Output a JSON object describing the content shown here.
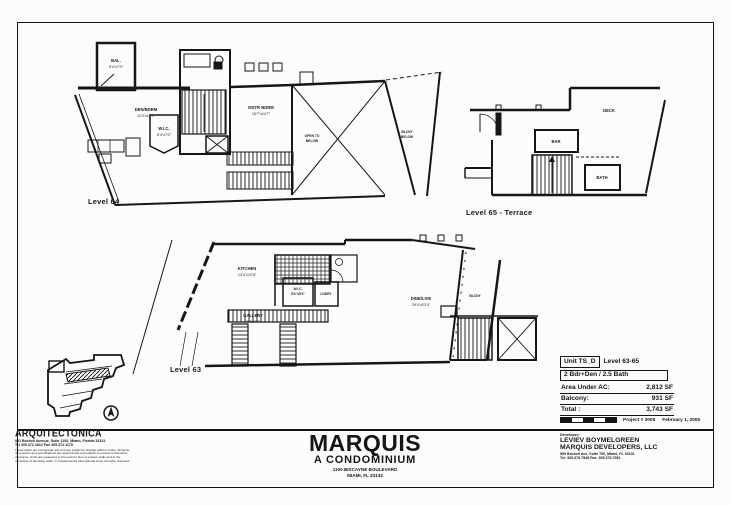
{
  "colors": {
    "ink": "#161616",
    "paper": "#fcfcfa"
  },
  "sheet": {
    "title": "MARQUIS",
    "subtitle": "A CONDOMINIUM",
    "address_line1": "1100 BISCAYNE BOULEVARD",
    "address_line2": "MIAMI, FL 33132"
  },
  "plans": {
    "level64": {
      "label": "Level 64",
      "rooms": {
        "bal": "BAL.",
        "bal_dim": "5'4\"x7'0\"",
        "den": "DEN/BDRM",
        "den_dim": "11'0\"x12'0\"",
        "wic": "W.I.C.",
        "wic_dim": "6'4\"x7'0\"",
        "mstr": "MSTR BDRM",
        "mstr_dim": "15'7\"x14'7\"",
        "open1": "OPEN TO",
        "open2": "BELOW",
        "bal_below1": "BLCNY",
        "bal_below2": "BELOW"
      }
    },
    "level65": {
      "label": "Level 65 - Terrace",
      "rooms": {
        "deck": "DECK",
        "bar": "BAR",
        "bath": "BATH"
      }
    },
    "level63": {
      "label": "Level 63",
      "rooms": {
        "kitchen": "KITCHEN",
        "kitchen_dim": "13'4\"x10'6\"",
        "wic": "W.I.C.",
        "wic_dim": "5'4\"x5'4\"",
        "lndry": "LNDRY",
        "gallery": "GALLERY",
        "gallery_dim": "7'4\"x7'4\"",
        "dine": "DINE/LIVE",
        "dine_dim": "29'4\"x23'4\"",
        "balcony": "BLCNY"
      }
    }
  },
  "unit_info": {
    "unit_label": "Unit TS_D",
    "level_label": "Level 63-65",
    "config": "2 Bdr+Den / 2.5 Bath",
    "rows": [
      {
        "label": "Area Under AC:",
        "value": "2,812 SF"
      },
      {
        "label": "Balcony:",
        "value": "931 SF"
      },
      {
        "label": "Total :",
        "value": "3,743 SF"
      }
    ]
  },
  "project_meta": {
    "project": "Project # 2005",
    "date": "February 1, 2005"
  },
  "architect": {
    "name": "ARQUITECTONICA",
    "address": "801 Brickell Avenue, Suite 1100, Miami, Florida 33131",
    "phone": "Tel 305.372.1812   Fax 305.372.1175",
    "disclaimer1": "These plans are conceptual only and are subject to change without notice. All plans,",
    "disclaimer2": "dimensions and specifications are approximate and subject to normal construction",
    "disclaimer3": "variances. Units are measured to the exterior face of exterior walls and to the",
    "disclaimer4": "centerline of demising walls. © Arquitectonica International Corp. All rights reserved."
  },
  "developer": {
    "heading": "Developer:",
    "name1": "LEVIEV BOYMELGREEN",
    "name2": "MARQUIS DEVELOPERS, LLC",
    "address": "999 Brickell Ave, Suite 700, Miami, FL 33131",
    "phone": "Tel: 305.379.7548   Fax: 305.379.7551"
  }
}
